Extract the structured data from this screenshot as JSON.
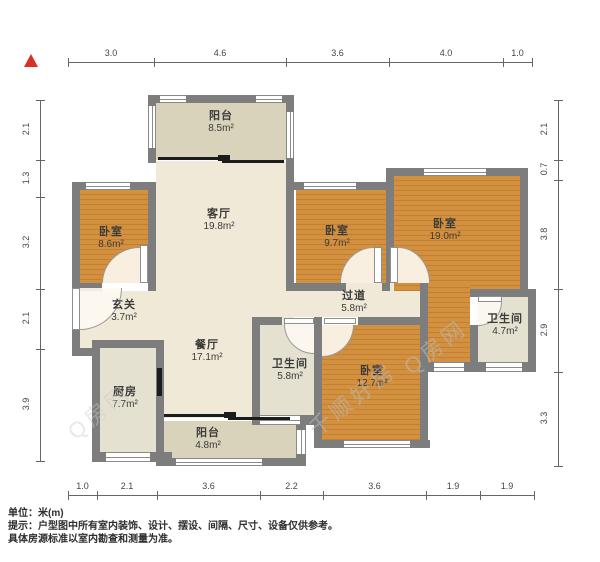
{
  "title": "户型图",
  "north": {
    "symbol": "north-triangle"
  },
  "rooms": [
    {
      "id": "balcony-top",
      "name": "阳台",
      "area": "8.5m²"
    },
    {
      "id": "living-room",
      "name": "客厅",
      "area": "19.8m²"
    },
    {
      "id": "bedroom-left",
      "name": "卧室",
      "area": "8.6m²"
    },
    {
      "id": "entry",
      "name": "玄关",
      "area": "3.7m²"
    },
    {
      "id": "dining-room",
      "name": "餐厅",
      "area": "17.1m²"
    },
    {
      "id": "kitchen",
      "name": "厨房",
      "area": "7.7m²"
    },
    {
      "id": "balcony-bottom",
      "name": "阳台",
      "area": "4.8m²"
    },
    {
      "id": "bedroom-middle",
      "name": "卧室",
      "area": "9.7m²"
    },
    {
      "id": "bedroom-right",
      "name": "卧室",
      "area": "19.0m²"
    },
    {
      "id": "hallway",
      "name": "过道",
      "area": "5.8m²"
    },
    {
      "id": "bathroom-middle",
      "name": "卫生间",
      "area": "5.8m²"
    },
    {
      "id": "bathroom-right",
      "name": "卫生间",
      "area": "4.7m²"
    },
    {
      "id": "bedroom-bottom",
      "name": "卧室",
      "area": "12.7m²"
    }
  ],
  "dimensions": {
    "top": [
      "3.0",
      "4.6",
      "3.6",
      "4.0",
      "1.0"
    ],
    "left": [
      "2.1",
      "1.3",
      "3.2",
      "2.1",
      "3.9"
    ],
    "right": [
      "2.1",
      "0.7",
      "3.8",
      "2.9",
      "3.3"
    ],
    "bottom": [
      "1.0",
      "2.1",
      "3.6",
      "2.2",
      "3.6",
      "1.9",
      "1.9"
    ]
  },
  "watermarks": [
    "千顺好房",
    "Q房网",
    "Q房网"
  ],
  "footer": {
    "unit": "单位：米(m)",
    "note1": "提示：户型图中所有室内装饰、设计、摆设、间隔、尺寸、设备仅供参考。",
    "note2": "具体房源标准以室内勘查和测量为准。"
  },
  "colors": {
    "wall": "#7d7d7d",
    "wood": "#d29040",
    "wood_dark": "#c2812e",
    "cream": "#f0e9d7",
    "balcony": "#d9d3bb",
    "tile": "#e4e1d0",
    "north_red": "#d93025"
  }
}
